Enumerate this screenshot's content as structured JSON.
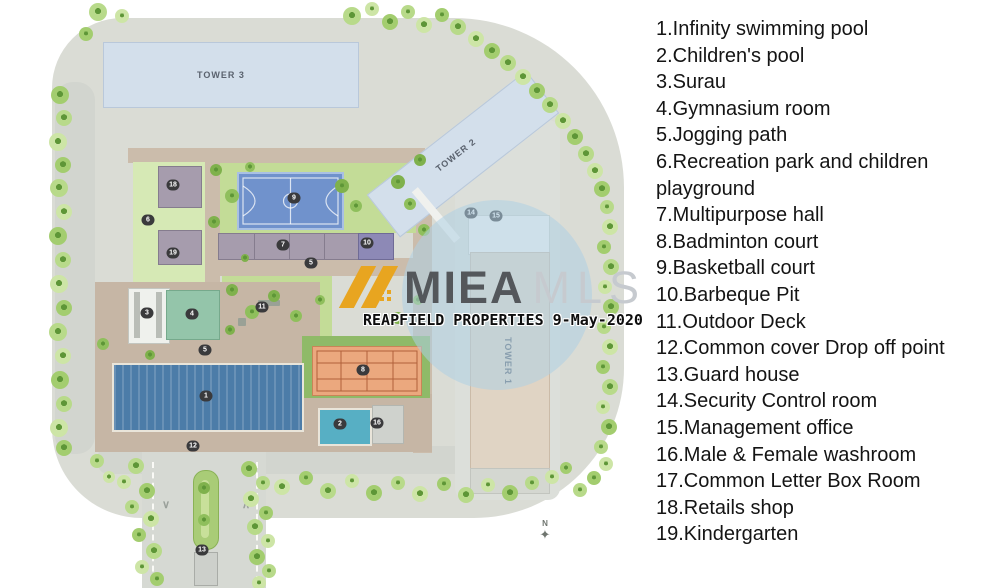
{
  "legend": {
    "items": [
      "1.Infinity swimming pool",
      "2.Children's pool",
      "3.Surau",
      "4.Gymnasium room",
      "5.Jogging path",
      "6.Recreation park and children playground",
      "7.Multipurpose hall",
      "8.Badminton court",
      "9.Basketball court",
      "10.Barbeque Pit",
      "11.Outdoor Deck",
      "12.Common cover Drop off point",
      "13.Guard house",
      "14.Security Control room",
      "15.Management office",
      "16.Male & Female washroom",
      "17.Common Letter Box Room",
      "18.Retails shop",
      "19.Kindergarten"
    ]
  },
  "plan": {
    "towers": {
      "t1": "TOWER 1",
      "t2": "TOWER 2",
      "t3": "TOWER 3"
    },
    "compass_label": "N",
    "markers": [
      {
        "n": "1"
      },
      {
        "n": "2"
      },
      {
        "n": "3"
      },
      {
        "n": "4"
      },
      {
        "n": "5"
      },
      {
        "n": "5"
      },
      {
        "n": "6"
      },
      {
        "n": "18"
      },
      {
        "n": "19"
      },
      {
        "n": "7"
      },
      {
        "n": "10"
      },
      {
        "n": "8"
      },
      {
        "n": "9"
      },
      {
        "n": "11"
      },
      {
        "n": "16"
      },
      {
        "n": "12"
      },
      {
        "n": "13"
      },
      {
        "n": "14"
      },
      {
        "n": "15"
      }
    ]
  },
  "watermark": {
    "brand_primary": "MIEA",
    "brand_secondary": "MLS",
    "tagline": "REAPFIELD PROPERTIES 9-May-2020"
  },
  "colors": {
    "pool_blue": "#4c7ca8",
    "childrens_pool_teal": "#57afc4",
    "basketball_court_blue": "#7092cc",
    "badminton_court_orange": "#eba87e",
    "multipurpose_hall_mauve": "#a69cad",
    "tower_blue": "#d3dfeb",
    "tower_beige": "#e0d4c4",
    "watermark_gold": "#e8a520",
    "watermark_circle_blue": "#aed0e4"
  }
}
